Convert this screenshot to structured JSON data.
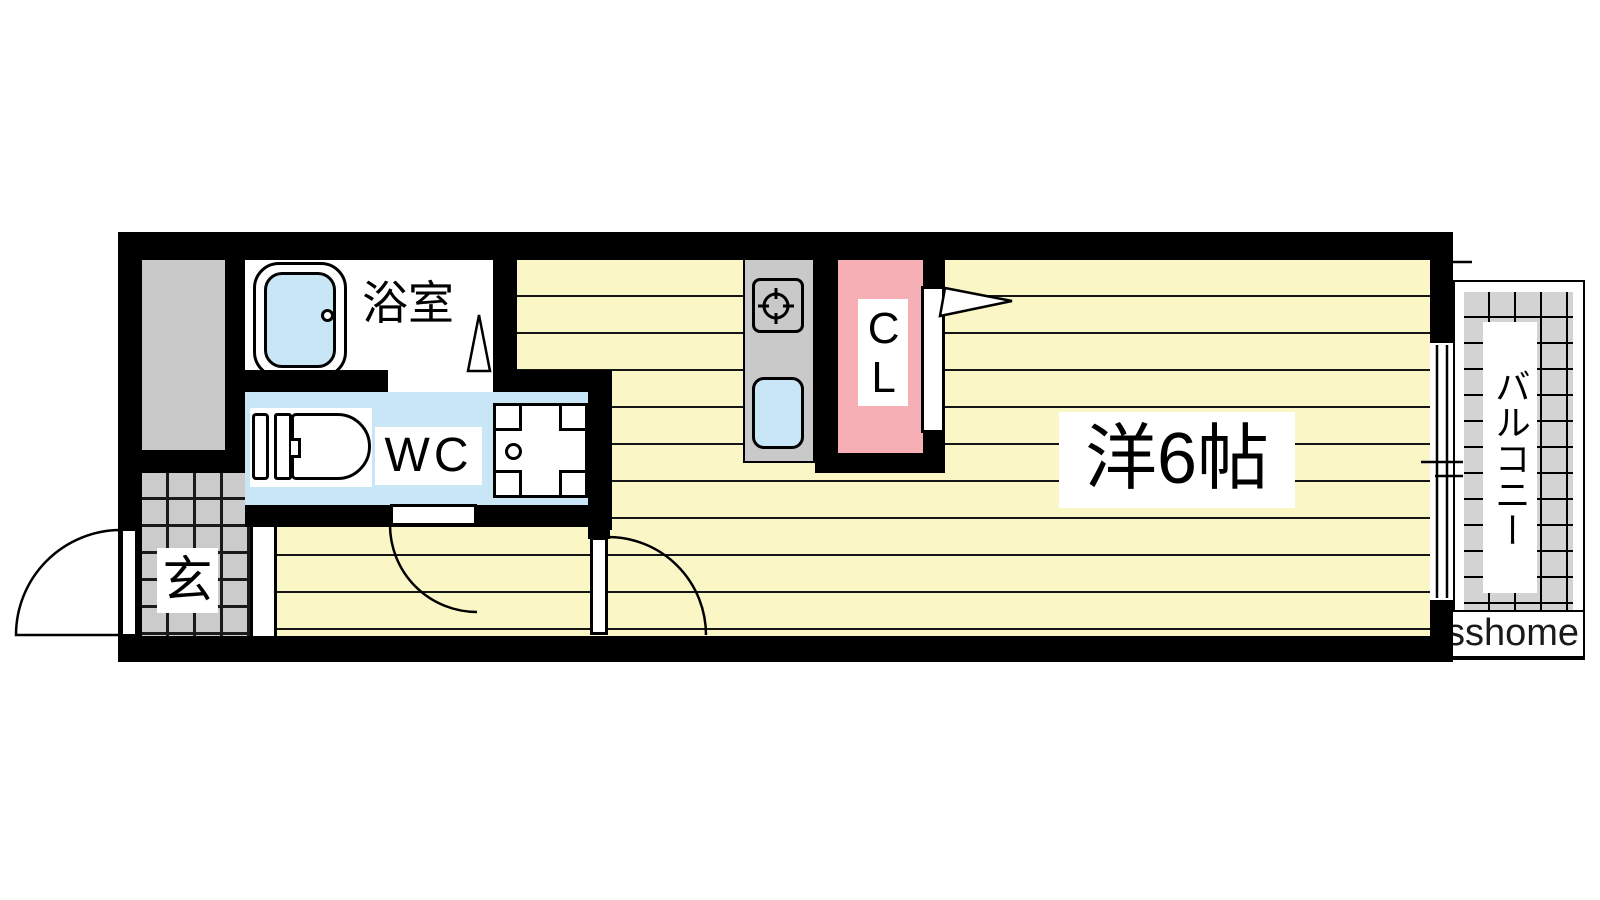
{
  "floorplan": {
    "rooms": {
      "bathroom": {
        "label": "浴室"
      },
      "toilet": {
        "label": "WC"
      },
      "entrance": {
        "label": "玄"
      },
      "closet": {
        "label": "CL"
      },
      "western_room": {
        "label": "洋6帖"
      },
      "balcony": {
        "label": "バルコニー"
      }
    },
    "watermark": {
      "text": "sshome"
    },
    "fixtures": [
      "bathtub-icon",
      "toilet-icon",
      "washbasin-icon",
      "stove-icon",
      "kitchen-sink-icon",
      "front-door",
      "wc-door",
      "hall-door",
      "closet-door",
      "sliding-window"
    ],
    "colors": {
      "wall": "#000000",
      "flooring_yellow": "#FBF6C5",
      "water_blue": "#C8E6F6",
      "closet_pink": "#F5AFB5",
      "entry_tile_gray": "#CBCBCB",
      "service_gray": "#C9C9C9",
      "balcony_tile_gray": "#D3D3D3"
    }
  }
}
